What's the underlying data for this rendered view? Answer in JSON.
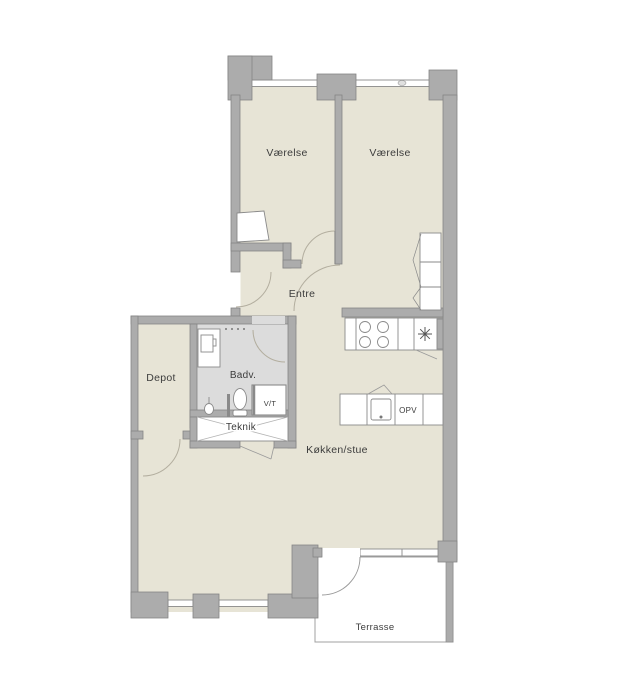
{
  "plan": {
    "type": "apartment-floor-plan",
    "rooms": {
      "bedroom1": {
        "label": "Værelse"
      },
      "bedroom2": {
        "label": "Værelse"
      },
      "entre": {
        "label": "Entre"
      },
      "depot": {
        "label": "Depot"
      },
      "bathroom": {
        "label": "Badv."
      },
      "vt_closet": {
        "label": "V/T"
      },
      "teknik": {
        "label": "Teknik"
      },
      "kitchen_living": {
        "label": "Køkken/stue"
      },
      "dishwasher": {
        "label": "OPV"
      },
      "terrace": {
        "label": "Terrasse"
      }
    },
    "colors": {
      "floor": "#e7e4d6",
      "bathroom_floor": "#dcdcdc",
      "wall_fill": "#acacac",
      "wall_stroke": "#858585",
      "fixture_stroke": "#8a8a8a",
      "door_arc": "#b3ae9f",
      "text": "#3c3c3c",
      "background": "#ffffff"
    }
  }
}
